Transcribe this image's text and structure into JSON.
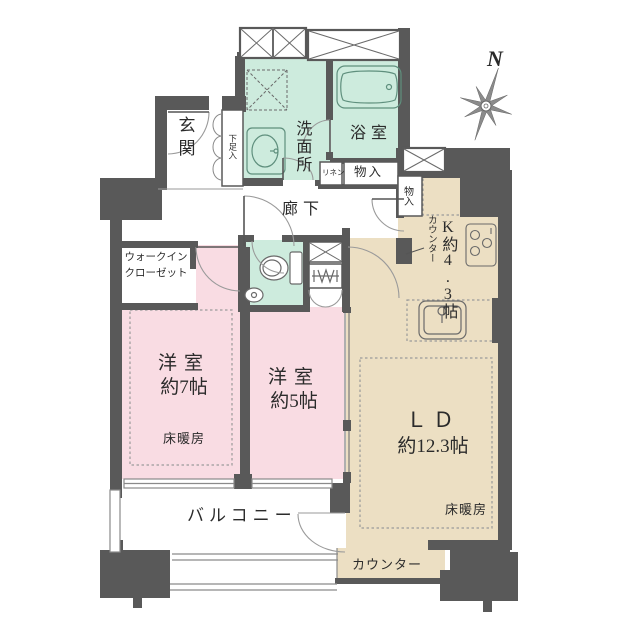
{
  "compass": {
    "north_label": "N"
  },
  "colors": {
    "wall": "#595959",
    "bedroom_pink": "#f9dce3",
    "wet_area_green": "#cdebdd",
    "living_beige": "#ecdfc3"
  },
  "rooms": {
    "entrance": {
      "label": "玄関"
    },
    "shoe_cabinet": {
      "label": "下足入"
    },
    "washroom": {
      "label": "洗面所"
    },
    "bathroom": {
      "label": "浴室"
    },
    "linen": {
      "label": "リネン"
    },
    "hall_storage": {
      "label": "物入"
    },
    "kitchen_storage": {
      "label": "物入"
    },
    "hallway": {
      "label": "廊下"
    },
    "kitchen": {
      "label": "K約4.3帖",
      "counter_label": "カウンター"
    },
    "walk_in_closet": {
      "label_line1": "ウォークイン",
      "label_line2": "クローゼット"
    },
    "bedroom7": {
      "label_line1": "洋室",
      "label_line2": "約7帖",
      "floor_heating_label": "床暖房"
    },
    "bedroom5": {
      "label_line1": "洋室",
      "label_line2": "約5帖"
    },
    "living_dining": {
      "label_line1": "ＬＤ",
      "label_line2": "約12.3帖",
      "floor_heating_label": "床暖房"
    },
    "balcony": {
      "label": "バルコニー"
    },
    "bottom_counter": {
      "label": "カウンター"
    }
  }
}
